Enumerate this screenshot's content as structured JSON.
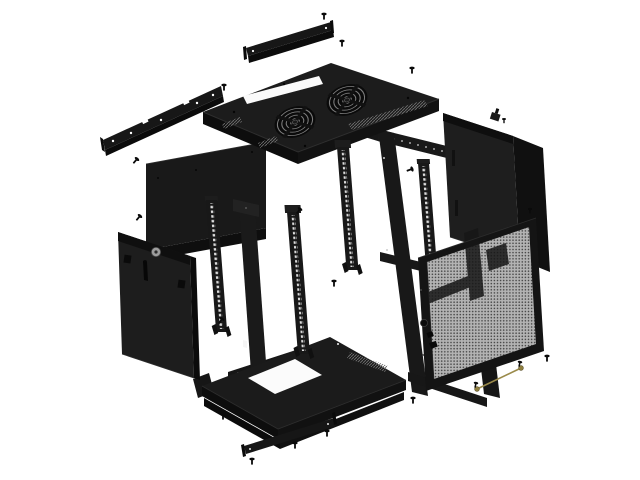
{
  "diagram": {
    "type": "exploded-view product illustration",
    "subject": "Wall-mount 19-inch network rack cabinet",
    "background_color": "#ffffff",
    "colors": {
      "part": "#1a1a1a",
      "part_shadow": "#0d0d0d",
      "mesh": "#b3b3b3",
      "mesh_dot": "#474747",
      "fan_ring": "#7d7d7d",
      "lock_silver": "#9d9d9d",
      "key_gold": "#9a8a4a"
    },
    "counts": {
      "fan_grilles": 2,
      "rack_rails": 4,
      "screws": 18,
      "keys": 2
    },
    "components": [
      {
        "id": "top-blanking-strip",
        "label": "Top blanking strip"
      },
      {
        "id": "wall-mount-bracket",
        "label": "Wall-mount bracket"
      },
      {
        "id": "top-cover",
        "label": "Top cover with twin fan grilles and cable slot"
      },
      {
        "id": "main-frame",
        "label": "Welded main frame"
      },
      {
        "id": "rear-panel",
        "label": "Rear panel"
      },
      {
        "id": "left-side-panel",
        "label": "Left side panel with lock"
      },
      {
        "id": "rack-rails",
        "label": "19-inch mounting rails"
      },
      {
        "id": "base-panel",
        "label": "Base panel with cable slot"
      },
      {
        "id": "bottom-blanking-strip",
        "label": "Bottom blanking strip"
      },
      {
        "id": "right-side-panel",
        "label": "Right side panel"
      },
      {
        "id": "perforated-door",
        "label": "Perforated front door with lock"
      },
      {
        "id": "key-set",
        "label": "Keys with wire"
      },
      {
        "id": "mounting-screws",
        "label": "Mounting screws"
      }
    ]
  }
}
